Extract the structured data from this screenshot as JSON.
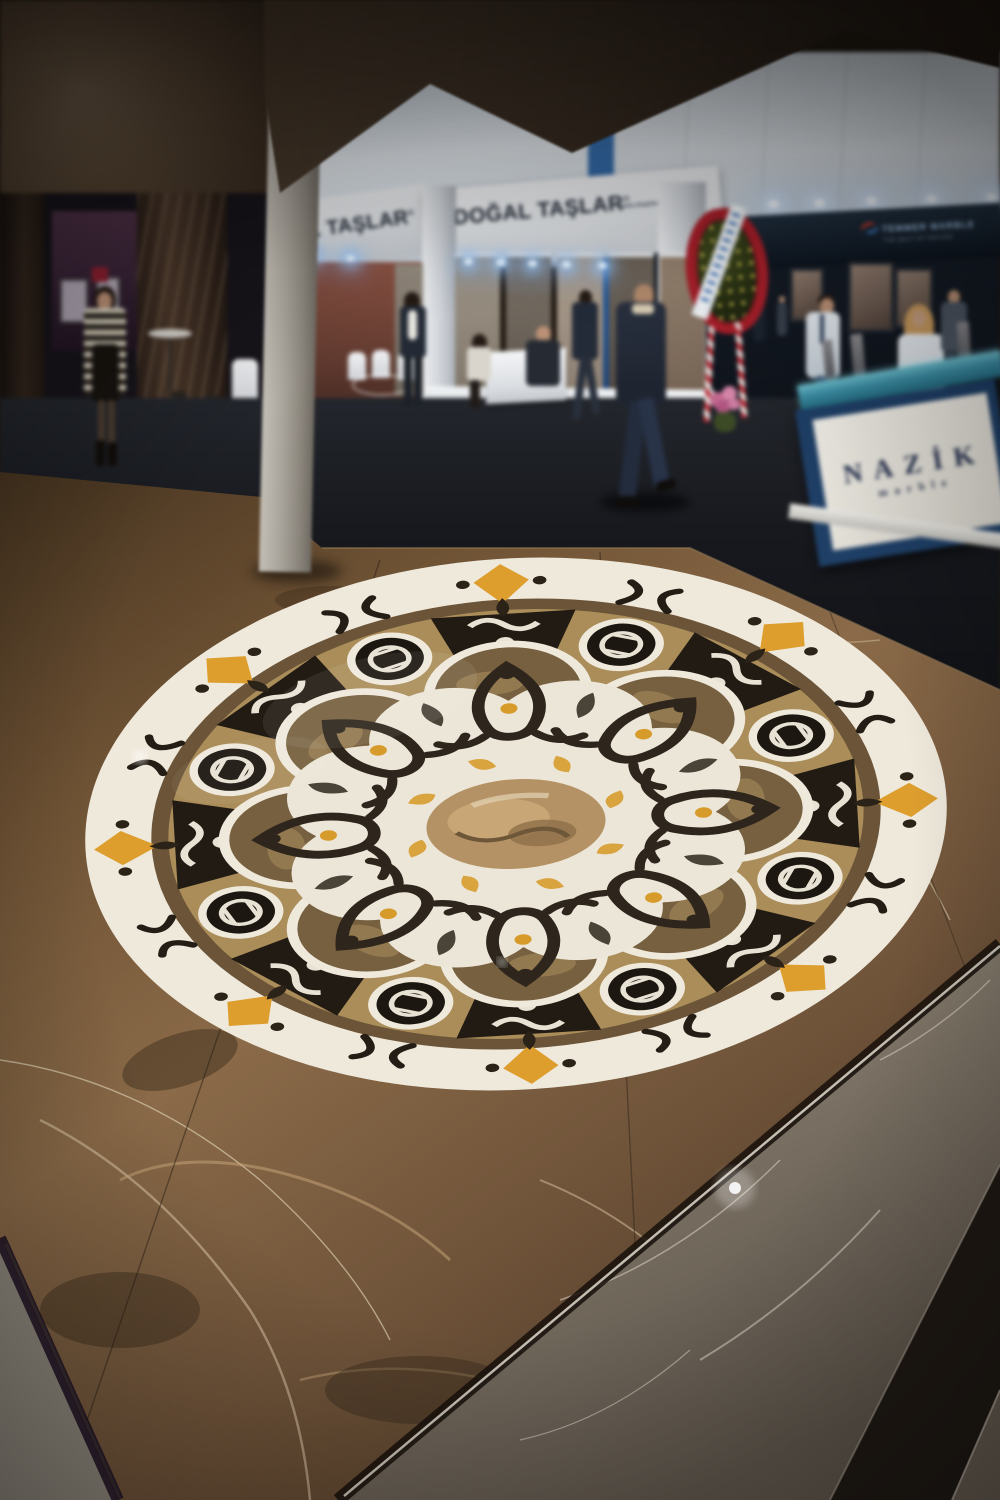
{
  "signs": {
    "left_fascia": {
      "label": "AL TAŞLAR",
      "reg": "®"
    },
    "center_fascia": {
      "label": "DOĞAL TAŞLAR",
      "reg": "®",
      "website": "www.dogaltaslar.com.tr"
    },
    "right_banner": {
      "brand": "TEMMER MARBLE",
      "tagline": "THE BEST OF NATURE"
    },
    "counter": {
      "brand": "NAZİK",
      "sub": "marble"
    }
  },
  "palette": {
    "canopy_brown": "#3f3226",
    "floor_brown": "#7a5b3c",
    "medallion_white": "#efe9dc",
    "medallion_tan": "#ab8d5a",
    "medallion_black": "#221b13",
    "medallion_gold": "#d79b2c",
    "counter_teal": "#3b8ca3",
    "counter_navy": "#1f3f66",
    "sign_navy": "#1e2733",
    "banner_navy": "#16202e",
    "wreath_red": "#a81f2a",
    "carpet_dark": "#17191e"
  }
}
